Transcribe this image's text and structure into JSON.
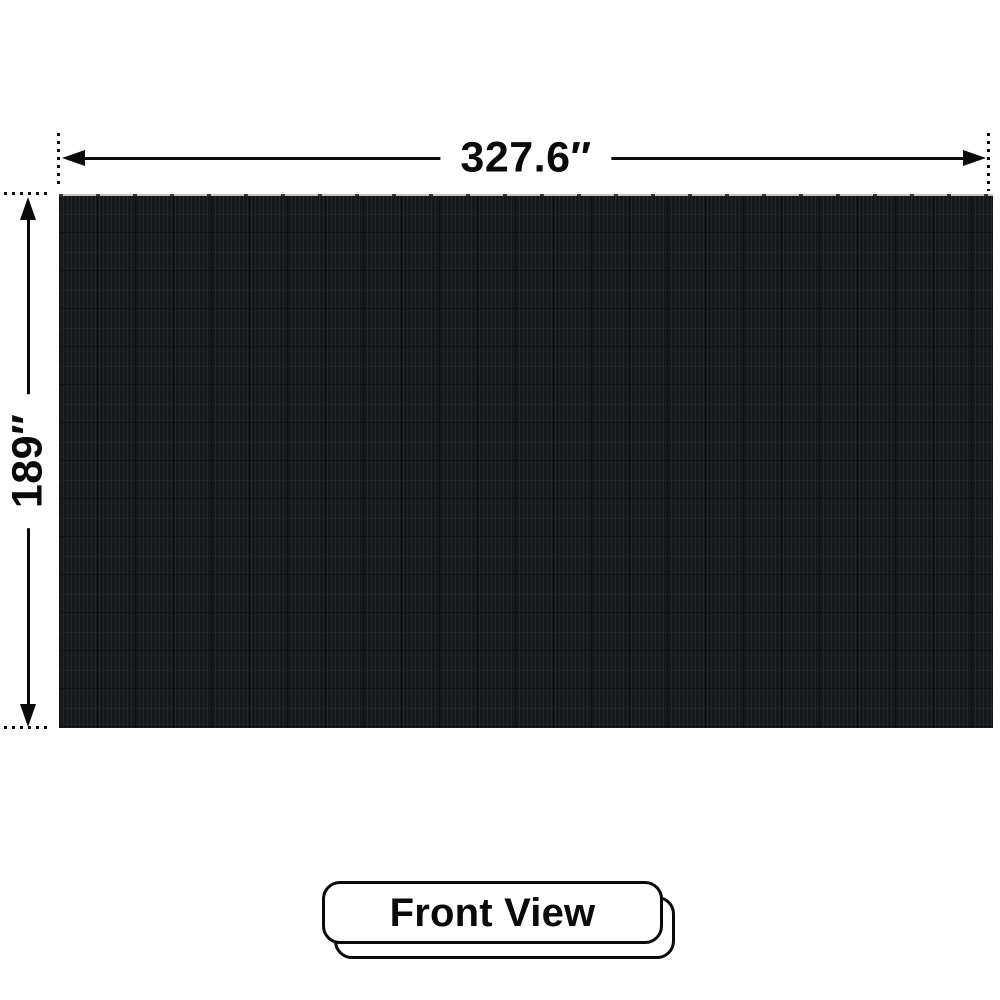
{
  "diagram": {
    "view_label": "Front View",
    "width_dimension": "327.6″",
    "height_dimension": "189″"
  },
  "icons": {
    "arrow_left": "dimension-arrow-left",
    "arrow_right": "dimension-arrow-right",
    "arrow_up": "dimension-arrow-up",
    "arrow_down": "dimension-arrow-down"
  },
  "colors": {
    "background": "#ffffff",
    "dimension_line": "#0a0a0a",
    "text": "#0a0a0a",
    "panel_base": "#17181a",
    "panel_stripe_light": "#222427",
    "panel_seam_dark": "#0c0d0e",
    "panel_top_strip": "#c2c2c2",
    "badge_fill": "#ffffff",
    "badge_border": "#0a0a0a"
  }
}
